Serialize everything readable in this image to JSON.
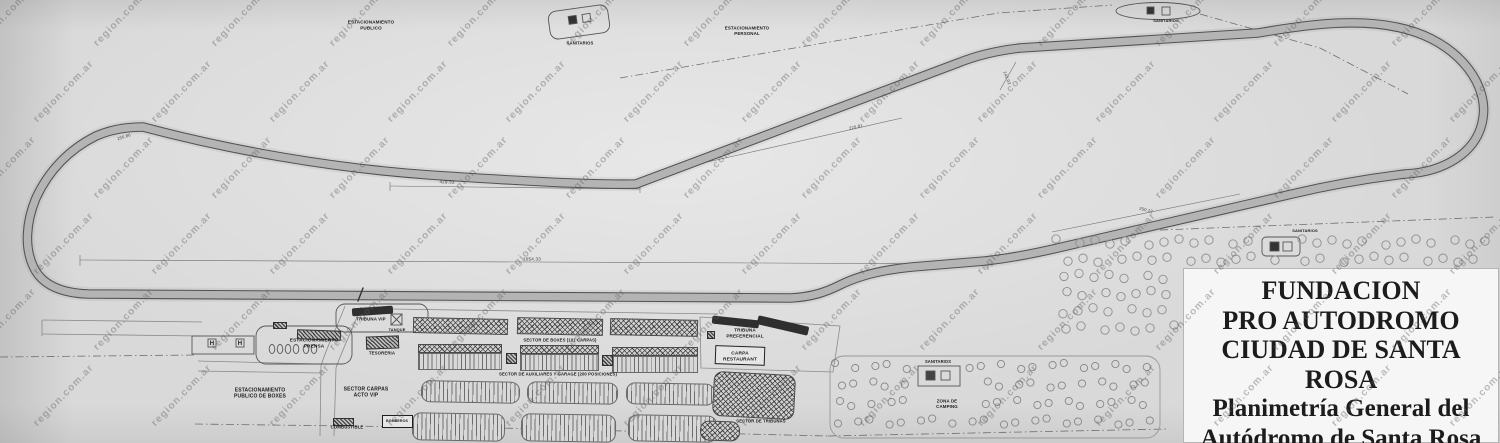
{
  "title_block": {
    "lines": [
      "FUNDACION",
      "PRO AUTODROMO",
      "CIUDAD DE SANTA ROSA",
      "Planimetría General del",
      "Autódromo de Santa Rosa"
    ]
  },
  "watermark": {
    "text": "region.com.ar",
    "cols": 13,
    "rows": 6,
    "dx": 118,
    "dy": 76,
    "row_offset": 58
  },
  "colors": {
    "paper": "#d9d9d9",
    "road": "#b4b4b4",
    "road_edge": "#525252",
    "ink": "#1c1c1c",
    "watermark_gray": "#5f5f5f"
  },
  "facility_labels": [
    {
      "text": "ESTACIONAMIENTO\nPUBLICO",
      "x": 371,
      "y": 25,
      "fs": 4.6,
      "name": "label-estacionamiento-publico"
    },
    {
      "text": "SANITARIOS",
      "x": 580,
      "y": 43,
      "fs": 4.2,
      "name": "label-sanitarios-top"
    },
    {
      "text": "ESTACIONAMIENTO\nPERSONAL",
      "x": 747,
      "y": 31,
      "fs": 4.4,
      "name": "label-estacionamiento-personal"
    },
    {
      "text": "SANITARIOS",
      "x": 1166,
      "y": 21,
      "fs": 4.0,
      "name": "label-sanitarios-top-right"
    },
    {
      "text": "TRIBUNA VIP",
      "x": 371,
      "y": 319,
      "fs": 4.4,
      "name": "label-tribuna-vip"
    },
    {
      "text": "TANQUE",
      "x": 397,
      "y": 330,
      "fs": 3.9,
      "name": "label-tanque"
    },
    {
      "text": "ESTACIONAMIENTO\nPRENSA",
      "x": 314,
      "y": 343,
      "fs": 4.8,
      "name": "label-estacionamiento-prensa"
    },
    {
      "text": "TESORERIA",
      "x": 382,
      "y": 353,
      "fs": 4.3,
      "name": "label-tesoreria"
    },
    {
      "text": "H",
      "x": 212,
      "y": 343,
      "fs": 6,
      "name": "label-helipad-h-1"
    },
    {
      "text": "H",
      "x": 240,
      "y": 343,
      "fs": 6,
      "name": "label-helipad-h-2"
    },
    {
      "text": "SECTOR CARPAS\nACTO VIP",
      "x": 366,
      "y": 392,
      "fs": 5,
      "name": "label-sector-carpas-acto-vip"
    },
    {
      "text": "ESTACIONAMIENTO\nPUBLICO DE BOXES",
      "x": 260,
      "y": 393,
      "fs": 5,
      "name": "label-estacionamiento-publico-de-boxes"
    },
    {
      "text": "COMBUSTIBLE",
      "x": 347,
      "y": 427,
      "fs": 4.3,
      "name": "label-combustible"
    },
    {
      "text": "BOMBEROS",
      "x": 397,
      "y": 421,
      "fs": 3.6,
      "name": "label-bomberos"
    },
    {
      "text": "SECTOR DE BOXES (101 CARPAS)",
      "x": 560,
      "y": 340,
      "fs": 4.2,
      "name": "label-sector-de-boxes"
    },
    {
      "text": "SECTOR DE AUXILIARES Y GARAGE (200 POSICIONES)",
      "x": 558,
      "y": 374,
      "fs": 4.2,
      "name": "label-sector-auxiliares-garage"
    },
    {
      "text": "TRIBUNA\nPREFERENCIAL",
      "x": 745,
      "y": 333,
      "fs": 4.6,
      "name": "label-tribuna-preferencial"
    },
    {
      "text": "CARPA\nRESTAURANT",
      "x": 740,
      "y": 356,
      "fs": 4.8,
      "name": "label-carpa-restaurant"
    },
    {
      "text": "SECTOR DE TRIBUNAS",
      "x": 761,
      "y": 421,
      "fs": 4.2,
      "name": "label-sector-de-tribunas"
    },
    {
      "text": "SANITARIOS",
      "x": 938,
      "y": 362,
      "fs": 4.1,
      "name": "label-sanitarios-camping"
    },
    {
      "text": "ZONA DE\nCAMPING",
      "x": 947,
      "y": 404,
      "fs": 4.4,
      "name": "label-zona-de-camping"
    },
    {
      "text": "SANITARIOS",
      "x": 1305,
      "y": 231,
      "fs": 4.0,
      "name": "label-sanitarios-right"
    }
  ],
  "dimension_labels": [
    {
      "text": "429.53",
      "x": 447,
      "y": 182,
      "fs": 4.6,
      "rot": 1,
      "name": "dim-429-53"
    },
    {
      "text": "1054.33",
      "x": 532,
      "y": 259,
      "fs": 4.6,
      "rot": 0,
      "name": "dim-1054-33"
    },
    {
      "text": "229.81",
      "x": 856,
      "y": 127,
      "fs": 4.2,
      "rot": -13,
      "name": "dim-229-81"
    },
    {
      "text": "142.02",
      "x": 1007,
      "y": 78,
      "fs": 4.2,
      "rot": 68,
      "name": "dim-142-02"
    },
    {
      "text": "250.12",
      "x": 1146,
      "y": 210,
      "fs": 4.2,
      "rot": 13,
      "name": "dim-250-12"
    },
    {
      "text": "256.86",
      "x": 124,
      "y": 137,
      "fs": 4.2,
      "rot": -18,
      "name": "dim-256-86"
    }
  ]
}
